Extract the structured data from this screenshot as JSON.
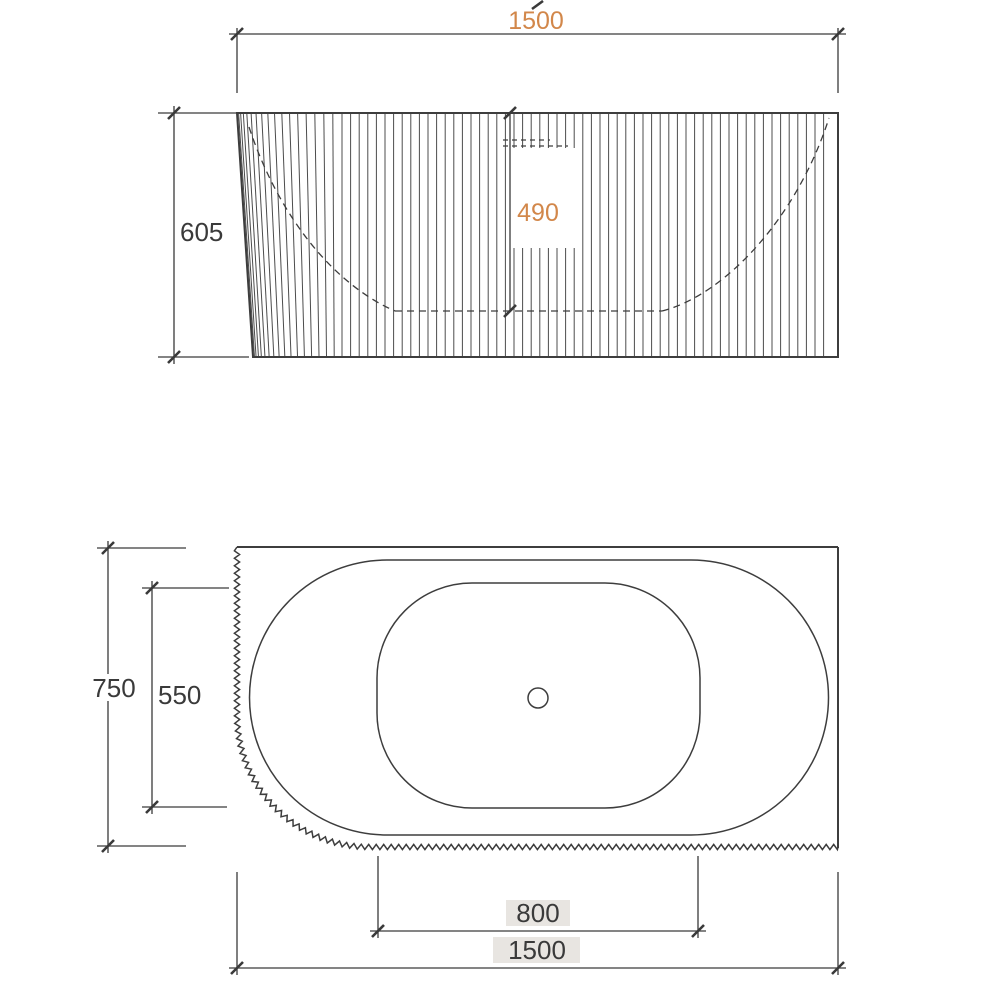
{
  "drawing": {
    "type": "technical-drawing",
    "subject": "fluted back-to-wall bathtub, front elevation and plan view",
    "background": "#ffffff",
    "colors": {
      "line": "#3d3d3d",
      "dim": "#3a3a3a",
      "accent": "#d2874a",
      "label_bg": "#e8e5e1"
    },
    "elevation": {
      "view": "front-elevation",
      "dim_overall_length": "1500",
      "dim_overall_height": "605",
      "dim_internal_depth": "490"
    },
    "plan": {
      "view": "plan",
      "dim_overall_width": "750",
      "dim_internal_width": "550",
      "dim_basin_length": "800",
      "dim_overall_length": "1500"
    }
  }
}
